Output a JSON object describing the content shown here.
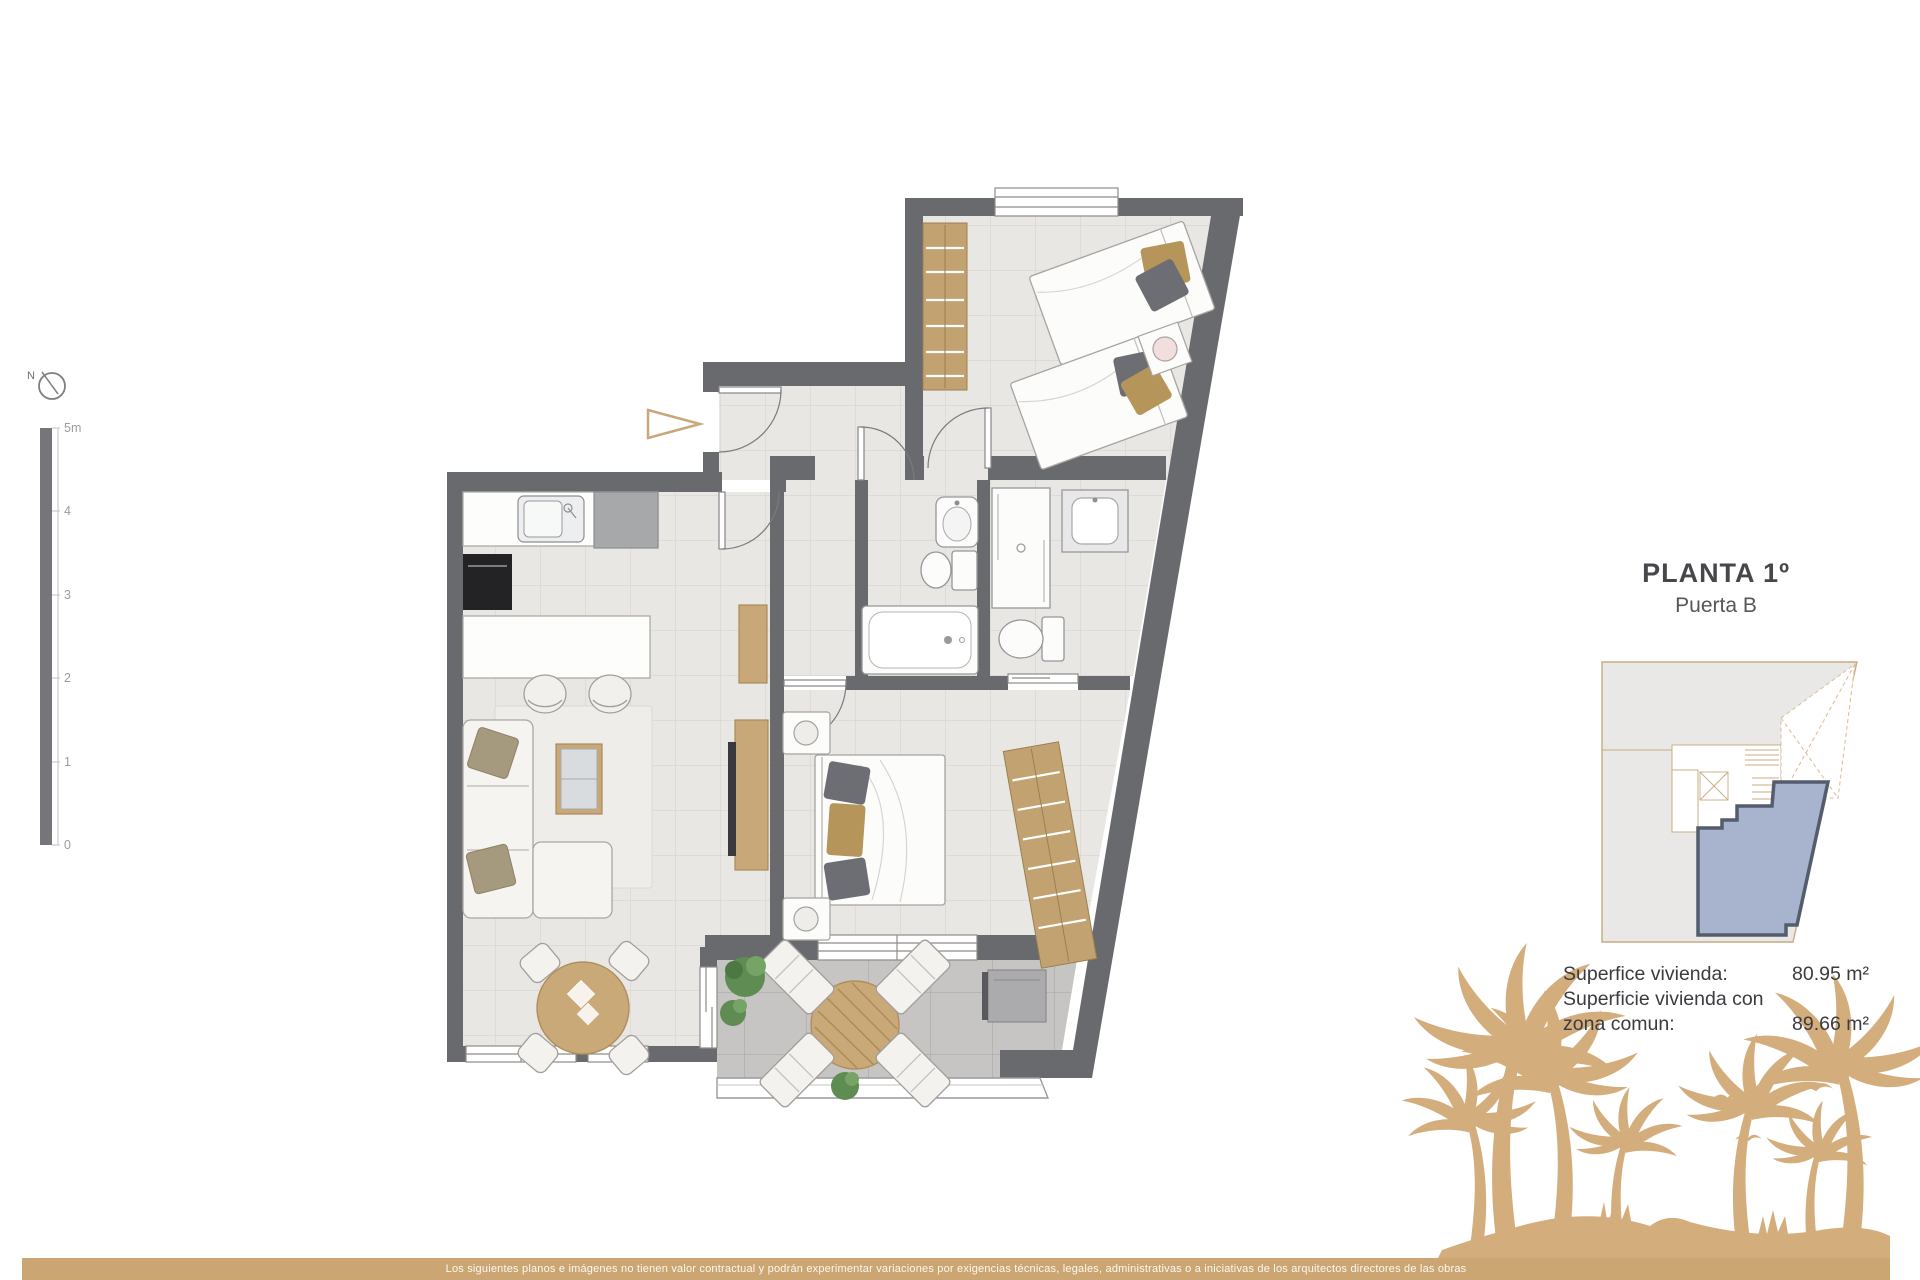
{
  "header": {
    "title": "PLANTA 1º",
    "subtitle": "Puerta B"
  },
  "areas": {
    "line1_label": "Superfice vivienda:",
    "line1_value": "80.95 m²",
    "line2_label": "Superficie vivienda con",
    "line3_label": "zona comun:",
    "line3_value": "89.66 m²"
  },
  "scale_bar": {
    "labels": [
      "5m",
      "4",
      "3",
      "2",
      "1",
      "0"
    ]
  },
  "compass": {
    "label": "N"
  },
  "footer": {
    "disclaimer": "Los siguientes planos e imágenes no tienen valor contractual y podrán experimentar variaciones por exigencias técnicas, legales, administrativas o a iniciativas de los arquitectos directores de las obras"
  },
  "key_plan": {
    "highlight_fill": "#A8B3CE",
    "highlight_stroke": "#545D6D",
    "outline_color": "#C9AC80"
  },
  "colors": {
    "accent_tan": "#CBA672",
    "palm_silhouette": "#D4AD7D",
    "wall_gray": "#696A6E",
    "wood": "#C8A878",
    "floor_tile": "#E9E7E4",
    "terrace_tile": "#C7C5C3"
  },
  "icons": [
    "north-compass-icon",
    "entrance-arrow-icon",
    "palm-tree-icon",
    "bird-icon"
  ]
}
